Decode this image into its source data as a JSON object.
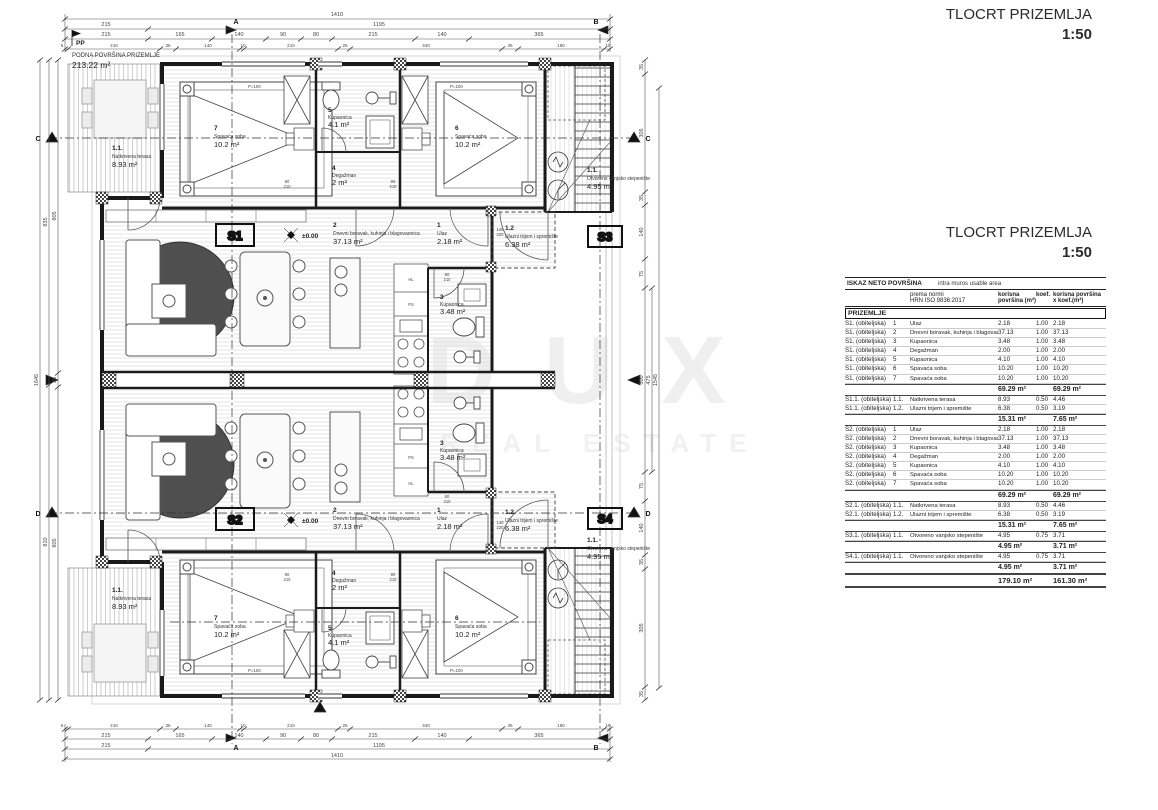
{
  "titles": {
    "plan_title": "TLOCRT PRIZEMLJA",
    "scale": "1:50"
  },
  "watermark": {
    "line1": "DUX",
    "line2": "REAL ESTATE"
  },
  "floor_note": {
    "code": "PP",
    "name": "PODNA POVRŠINA PRIZEMLJE",
    "area": "213.22 m²"
  },
  "plan": {
    "units": {
      "s1": "S1",
      "s2": "S2",
      "s3": "S3",
      "s4": "S4"
    },
    "level": "±0.00",
    "window_label": "P=100",
    "rooms": {
      "ulaz": {
        "num": "1",
        "name": "Ulaz",
        "area": "2.18 m²"
      },
      "living": {
        "num": "2",
        "name": "Dnevni boravak, kuhinja i blagovaonica",
        "area": "37.13 m²"
      },
      "kupaonica3": {
        "num": "3",
        "name": "Kupaonica",
        "area": "3.48 m²"
      },
      "degazman": {
        "num": "4",
        "name": "Degažman",
        "area": "2 m²"
      },
      "kupaonica5": {
        "num": "5",
        "name": "Kupaonica",
        "area": "4.1 m²"
      },
      "spavaca6": {
        "num": "6",
        "name": "Spavaća soba",
        "area": "10.2 m²"
      },
      "spavaca7": {
        "num": "7",
        "name": "Spavaća soba",
        "area": "10.2 m²"
      },
      "terasa": {
        "num": "1.1.",
        "name": "Natkrivena terasa",
        "area": "8.93 m²"
      },
      "trijem": {
        "num": "1.2",
        "name": "Ulazni trijem i spremište",
        "area": "6.38 m²"
      },
      "stepeniste": {
        "num": "1.1.",
        "name": "Otvoreno vanjsko stepenište",
        "area": "4.95 m²"
      }
    },
    "appliances": {
      "hl": "HL",
      "ps": "PS"
    },
    "door_tags": {
      "deg_w": "90",
      "deg_h": "210",
      "front_w": "140",
      "front_h": "220",
      "bath_w": "80",
      "bath_h": "210"
    },
    "markers": {
      "a": "A",
      "b": "B",
      "c": "C",
      "d": "D"
    },
    "dims": {
      "top_overall": "1410",
      "top_row2": [
        "215",
        "1195"
      ],
      "top_row3": [
        "215",
        "165",
        "140",
        "90",
        "80",
        "215",
        "140",
        "365"
      ],
      "top_row4": [
        "5",
        "210",
        "35",
        "140",
        "10",
        "210",
        "25",
        "340",
        "35",
        "190",
        "10"
      ],
      "left_outer": "1645",
      "left_mid": [
        "835",
        "810"
      ],
      "left_inner": [
        "805",
        "35",
        "805"
      ],
      "right_inner": [
        "35",
        "305",
        "35",
        "140",
        "75",
        "500",
        "75",
        "140",
        "35",
        "305",
        "35"
      ],
      "right_mid": "475",
      "right_outer": "1545"
    }
  },
  "table": {
    "title": "ISKAZ NETO POVRŠINA",
    "subtitle": "intra muros usable area",
    "norm_label": "prema normi",
    "norm_value": "HRN ISO 9836:2017",
    "col_area": "korisna površina (m²)",
    "col_koef": "koef.",
    "col_area_koef": "korisna površina x koef.(m²)",
    "section": "PRIZEMLJE",
    "rows": [
      {
        "kind": "r",
        "unit": "S1. (obiteljska)",
        "num": "1",
        "name": "Ulaz",
        "a": "2.18",
        "k": "1.00",
        "ak": "2.18"
      },
      {
        "kind": "r",
        "unit": "S1. (obiteljska)",
        "num": "2",
        "name": "Dnevni boravak, kuhinja i blagovaonica",
        "a": "37.13",
        "k": "1.00",
        "ak": "37.13"
      },
      {
        "kind": "r",
        "unit": "S1. (obiteljska)",
        "num": "3",
        "name": "Kupaonica",
        "a": "3.48",
        "k": "1.00",
        "ak": "3.48"
      },
      {
        "kind": "r",
        "unit": "S1. (obiteljska)",
        "num": "4",
        "name": "Degažman",
        "a": "2.00",
        "k": "1.00",
        "ak": "2.00"
      },
      {
        "kind": "r",
        "unit": "S1. (obiteljska)",
        "num": "5",
        "name": "Kupaonica",
        "a": "4.10",
        "k": "1.00",
        "ak": "4.10"
      },
      {
        "kind": "r",
        "unit": "S1. (obiteljska)",
        "num": "6",
        "name": "Spavaća soba",
        "a": "10.20",
        "k": "1.00",
        "ak": "10.20"
      },
      {
        "kind": "r",
        "unit": "S1. (obiteljska)",
        "num": "7",
        "name": "Spavaća soba",
        "a": "10.20",
        "k": "1.00",
        "ak": "10.20"
      },
      {
        "kind": "sub",
        "unit": "",
        "num": "",
        "name": "",
        "a": "69.29 m²",
        "k": "",
        "ak": "69.29 m²"
      },
      {
        "kind": "r",
        "unit": "S1.1. (obiteljska)",
        "num": "1.1.",
        "name": "Natkrivena terasa",
        "a": "8.93",
        "k": "0.50",
        "ak": "4.46"
      },
      {
        "kind": "r",
        "unit": "S1.1. (obiteljska)",
        "num": "1.2.",
        "name": "Ulazni trijem i spremište",
        "a": "6.38",
        "k": "0.50",
        "ak": "3.19"
      },
      {
        "kind": "sub",
        "unit": "",
        "num": "",
        "name": "",
        "a": "15.31 m²",
        "k": "",
        "ak": "7.65 m²"
      },
      {
        "kind": "r",
        "unit": "S2. (obiteljska)",
        "num": "1",
        "name": "Ulaz",
        "a": "2.18",
        "k": "1.00",
        "ak": "2.18"
      },
      {
        "kind": "r",
        "unit": "S2. (obiteljska)",
        "num": "2",
        "name": "Dnevni boravak, kuhinja i blagovaonica",
        "a": "37.13",
        "k": "1.00",
        "ak": "37.13"
      },
      {
        "kind": "r",
        "unit": "S2. (obiteljska)",
        "num": "3",
        "name": "Kupaonica",
        "a": "3.48",
        "k": "1.00",
        "ak": "3.48"
      },
      {
        "kind": "r",
        "unit": "S2. (obiteljska)",
        "num": "4",
        "name": "Degažman",
        "a": "2.00",
        "k": "1.00",
        "ak": "2.00"
      },
      {
        "kind": "r",
        "unit": "S2. (obiteljska)",
        "num": "5",
        "name": "Kupaonica",
        "a": "4.10",
        "k": "1.00",
        "ak": "4.10"
      },
      {
        "kind": "r",
        "unit": "S2. (obiteljska)",
        "num": "6",
        "name": "Spavaća soba",
        "a": "10.20",
        "k": "1.00",
        "ak": "10.20"
      },
      {
        "kind": "r",
        "unit": "S2. (obiteljska)",
        "num": "7",
        "name": "Spavaća soba",
        "a": "10.20",
        "k": "1.00",
        "ak": "10.20"
      },
      {
        "kind": "sub",
        "unit": "",
        "num": "",
        "name": "",
        "a": "69.29 m²",
        "k": "",
        "ak": "69.29 m²"
      },
      {
        "kind": "r",
        "unit": "S2.1. (obiteljska)",
        "num": "1.1.",
        "name": "Natkrivena terasa",
        "a": "8.93",
        "k": "0.50",
        "ak": "4.46"
      },
      {
        "kind": "r",
        "unit": "S2.1. (obiteljska)",
        "num": "1.2.",
        "name": "Ulazni trijem i spremište",
        "a": "6.38",
        "k": "0.50",
        "ak": "3.19"
      },
      {
        "kind": "sub",
        "unit": "",
        "num": "",
        "name": "",
        "a": "15.31 m²",
        "k": "",
        "ak": "7.65 m²"
      },
      {
        "kind": "r",
        "unit": "S3.1. (obiteljska)",
        "num": "1.1.",
        "name": "Otvoreno vanjsko stepenište",
        "a": "4.95",
        "k": "0.75",
        "ak": "3.71"
      },
      {
        "kind": "sub",
        "unit": "",
        "num": "",
        "name": "",
        "a": "4.95 m²",
        "k": "",
        "ak": "3.71 m²"
      },
      {
        "kind": "r",
        "unit": "S4.1. (obiteljska)",
        "num": "1.1.",
        "name": "Otvoreno vanjsko stepenište",
        "a": "4.95",
        "k": "0.75",
        "ak": "3.71"
      },
      {
        "kind": "sub",
        "unit": "",
        "num": "",
        "name": "",
        "a": "4.95 m²",
        "k": "",
        "ak": "3.71 m²"
      },
      {
        "kind": "total",
        "unit": "",
        "num": "",
        "name": "",
        "a": "179.10 m²",
        "k": "",
        "ak": "161.30 m²"
      }
    ]
  }
}
